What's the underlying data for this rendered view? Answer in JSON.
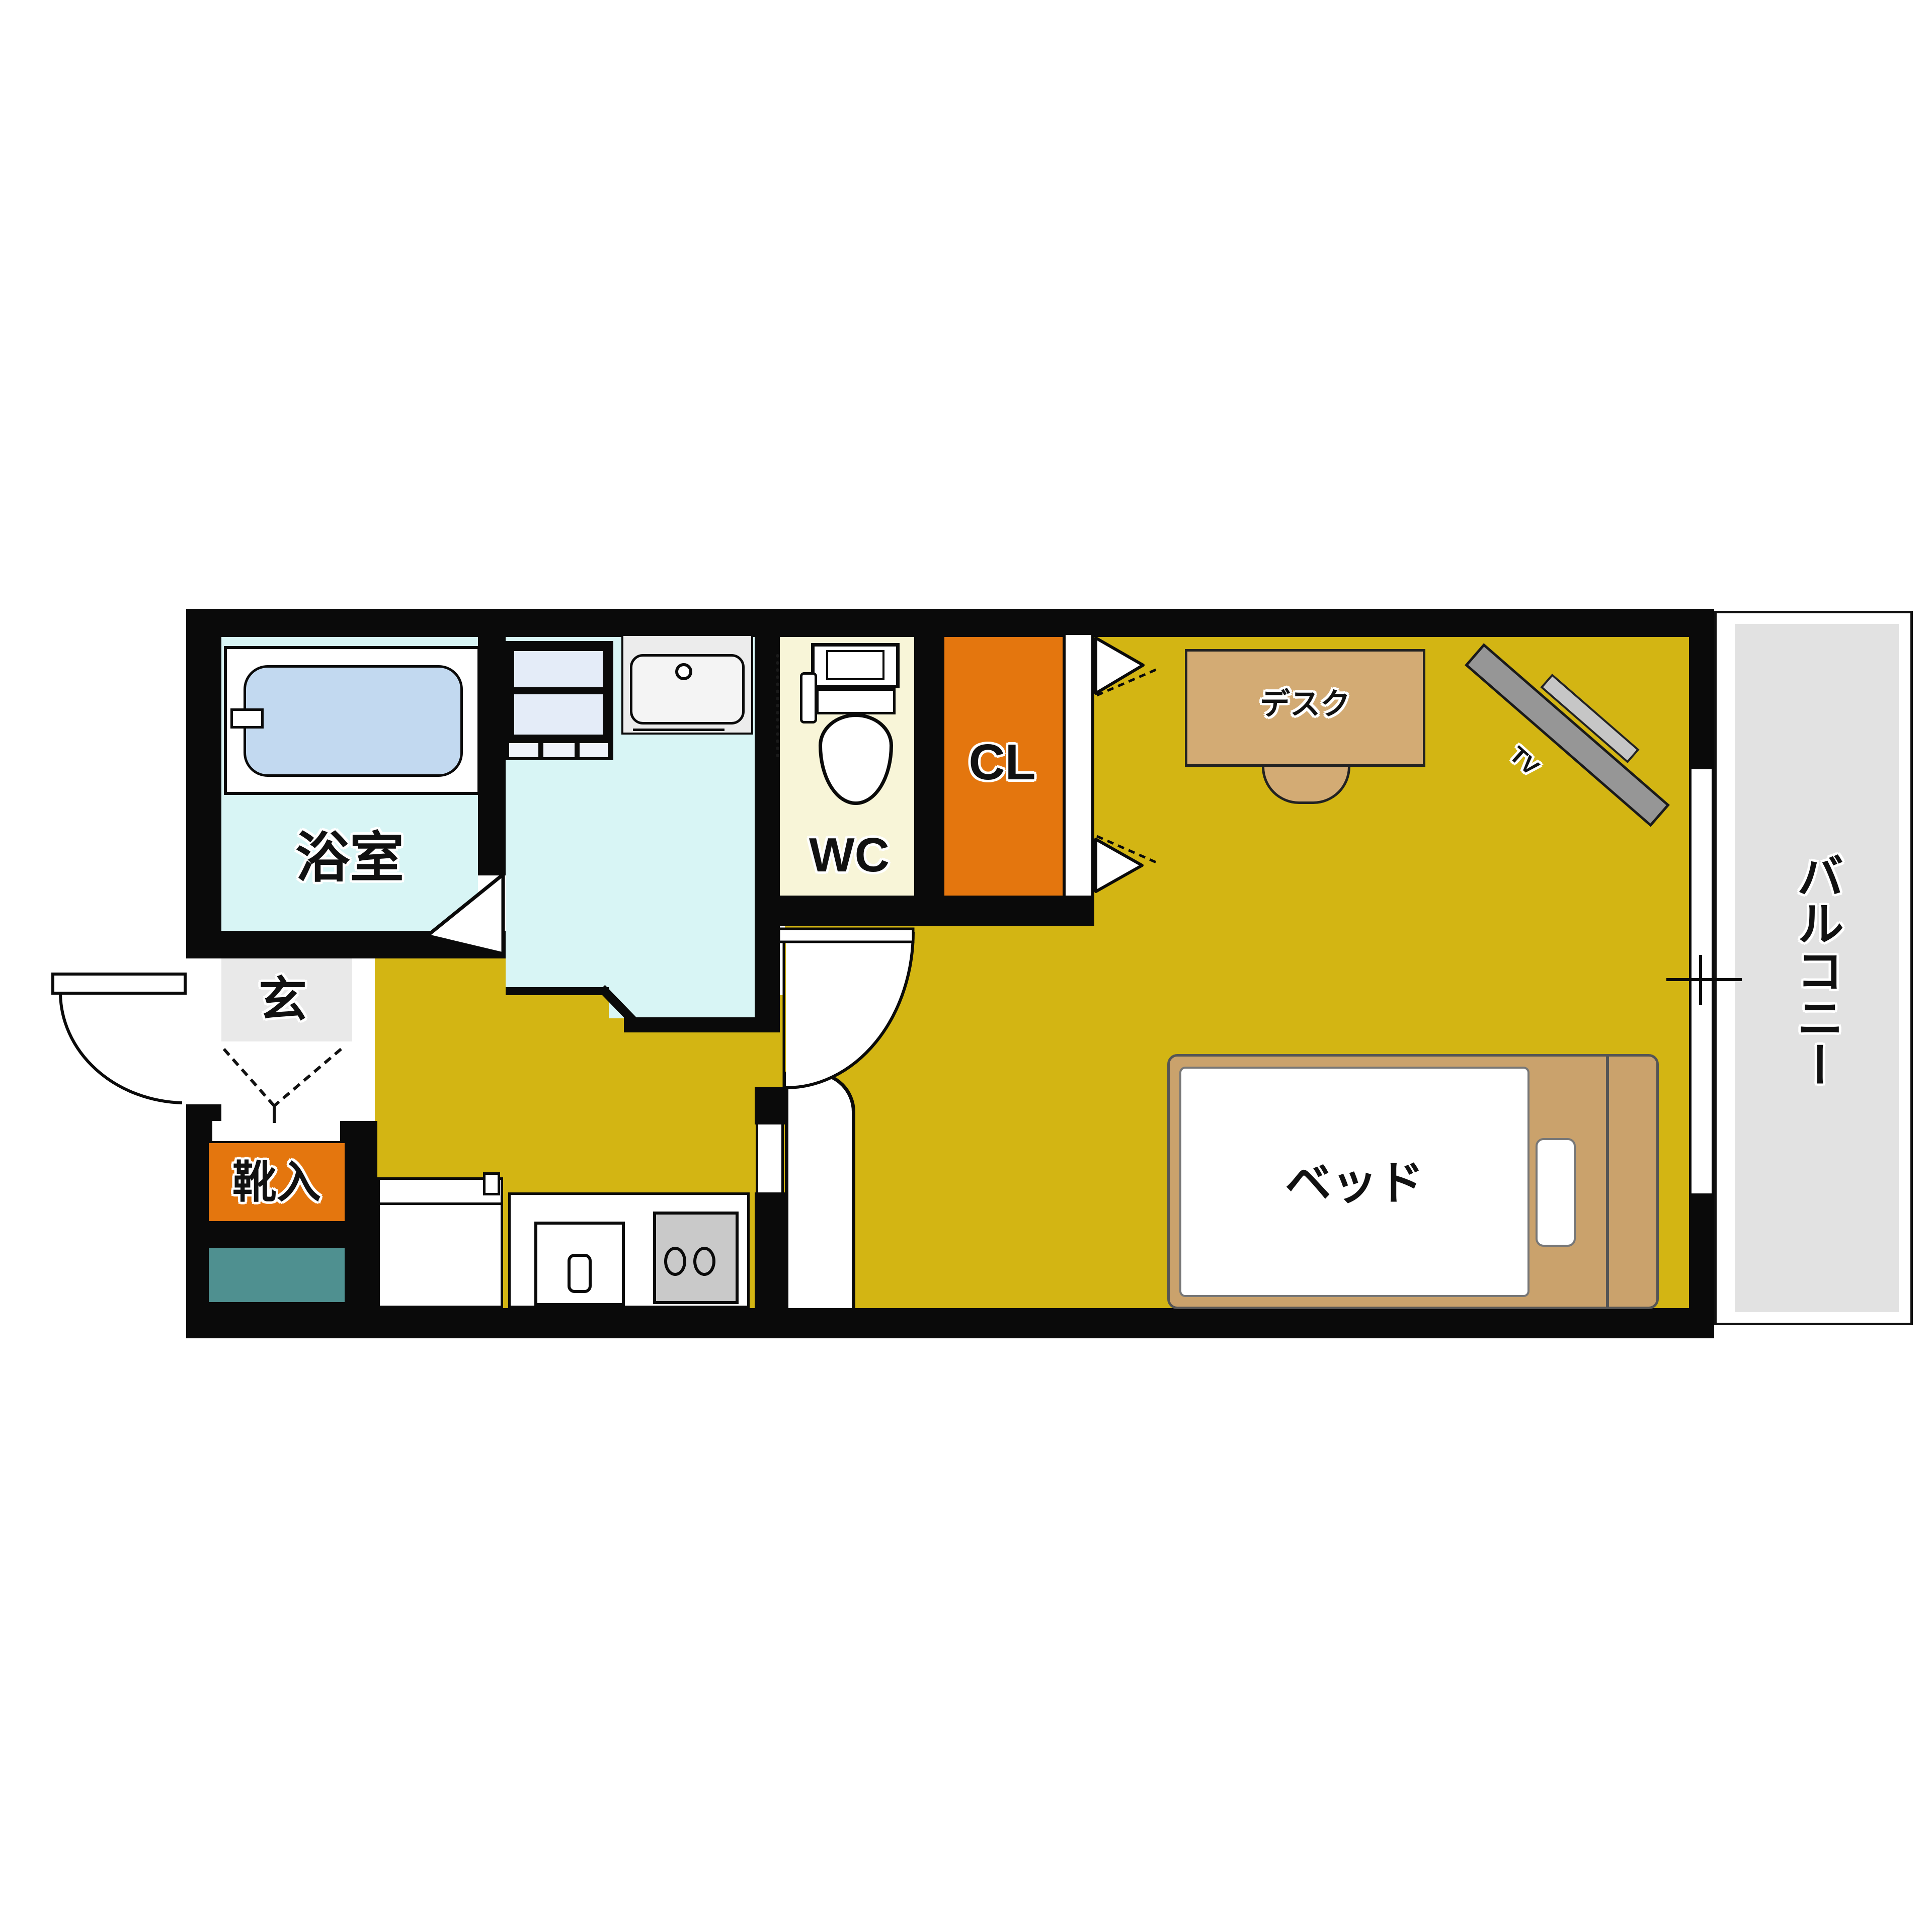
{
  "plan": {
    "type": "apartment-floor-plan-1K",
    "labels": {
      "bathroom": "浴室",
      "wc": "WC",
      "closet": "CL",
      "entrance": "玄",
      "shoe_cabinet": "靴入",
      "desk": "デスク",
      "tv": "TV",
      "bed": "ベッド",
      "balcony": "バルコニー"
    },
    "colors": {
      "wall": "#0a0a0a",
      "main_room_floor": "#d3b513",
      "wet_area_floor": "#d8f5f5",
      "bathtub_water": "#c2d9f0",
      "wc_floor": "#f8f5d8",
      "closet_orange": "#e4760e",
      "entrance_floor": "#e9e9e9",
      "utility_teal": "#4f9090",
      "balcony_floor": "#e2e2e2",
      "furniture_wood": "#d3ab74",
      "bed_frame": "#caa26c",
      "tv_body": "#969696",
      "stove_gray": "#c9c9c9"
    }
  }
}
